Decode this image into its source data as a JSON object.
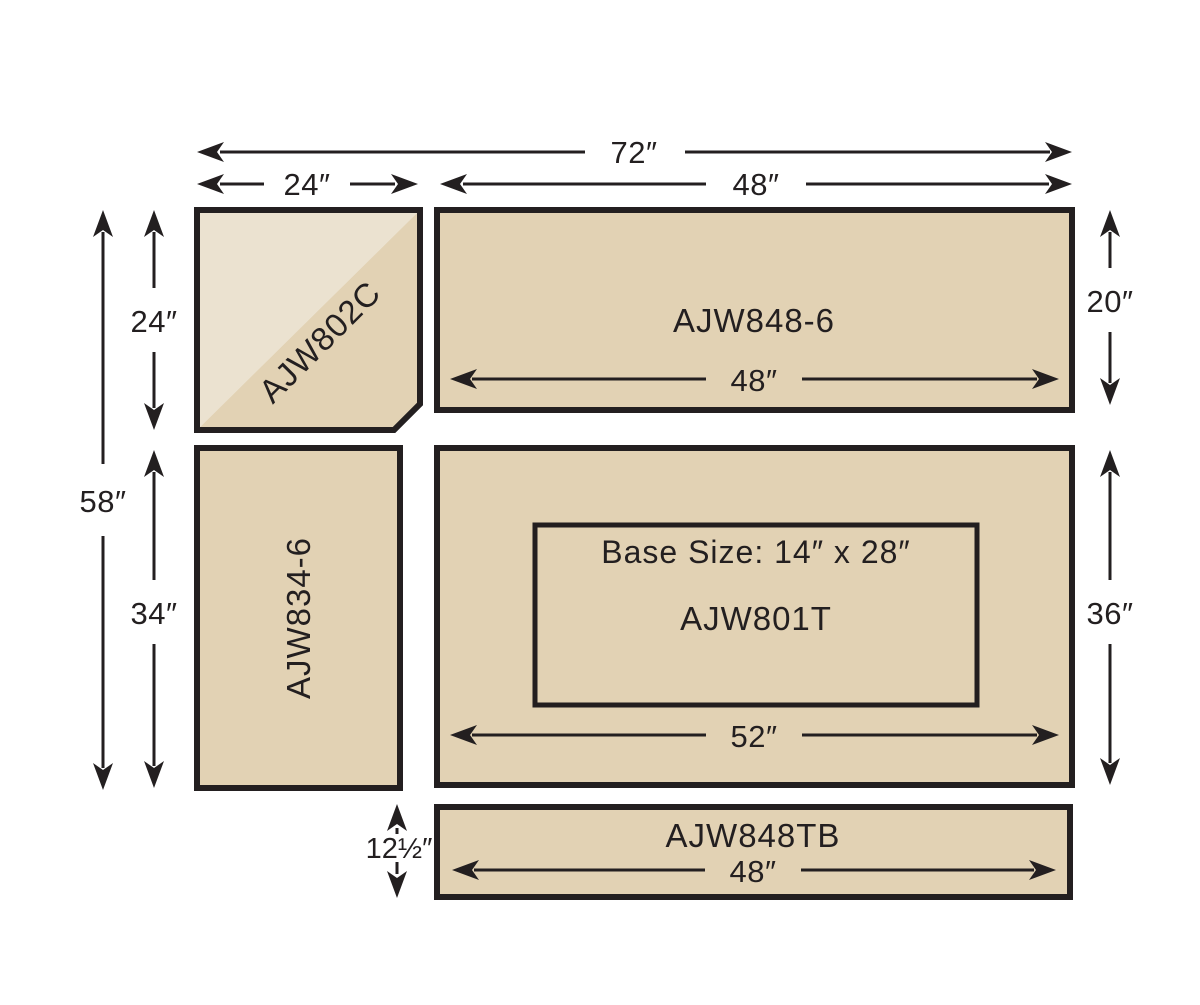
{
  "diagram": {
    "panels": {
      "corner": {
        "label": "AJW802C"
      },
      "shelf_top": {
        "label": "AJW848-6",
        "inner_width": "48″"
      },
      "side": {
        "label": "AJW834-6"
      },
      "worktop": {
        "label": "AJW801T",
        "base_size": "Base Size: 14″ x 28″",
        "inner_width": "52″"
      },
      "toeboard": {
        "label": "AJW848TB",
        "inner_width": "48″"
      }
    },
    "dims": {
      "overall_width": "72″",
      "corner_width": "24″",
      "right_width": "48″",
      "overall_height": "58″",
      "corner_height": "24″",
      "side_height": "34″",
      "shelf_height": "20″",
      "worktop_height": "36″",
      "toeboard_height": "12½″"
    },
    "colors": {
      "panel": "#e2d2b4",
      "panel_light": "#ebe2d0",
      "ink": "#231f20",
      "background": "#ffffff"
    }
  }
}
